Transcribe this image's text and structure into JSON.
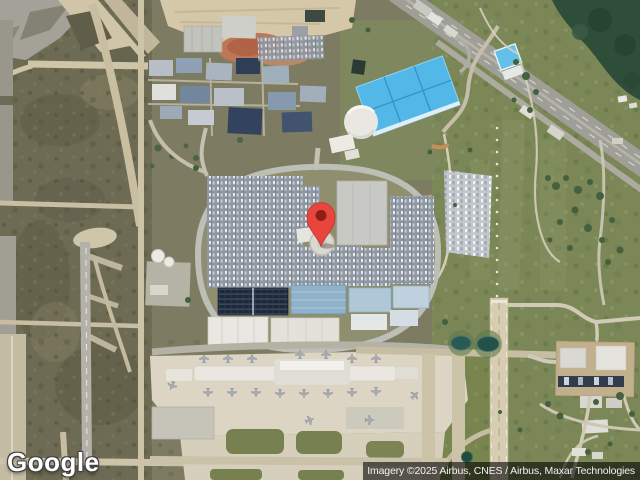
{
  "map": {
    "view": "satellite",
    "logo_text": "Google",
    "attribution_text": "Imagery ©2025 Airbus, CNES / Airbus, Maxar Technologies",
    "marker": {
      "name": "location-pin"
    }
  },
  "colors": {
    "pin_red": "#E8453C",
    "pin_dot": "#8C1F12",
    "attribution_bg": "rgba(0,0,0,0.60)",
    "attribution_fg": "#F2F2F2",
    "logo_fg": "#FFFFFF"
  }
}
